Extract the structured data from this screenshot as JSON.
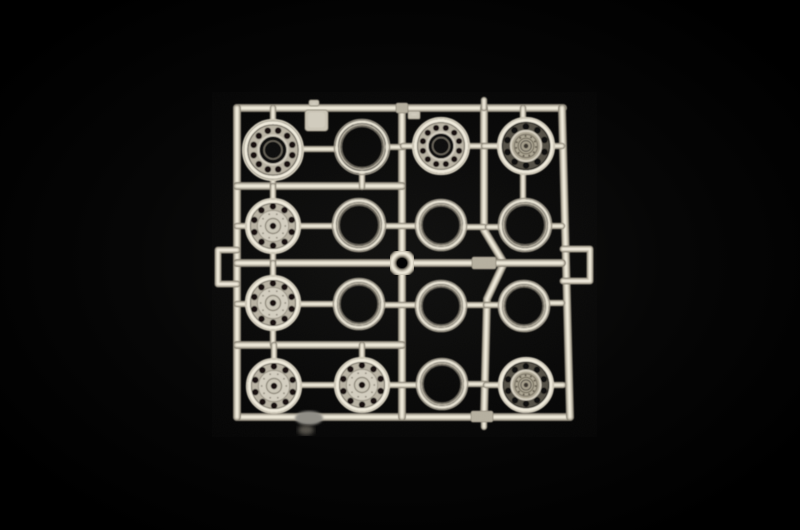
{
  "scene": {
    "subject": "Plastic model kit sprue with sixteen truck wheel parts photographed on a black background",
    "background": "#000000",
    "vignette_center": "#121211",
    "plastic": {
      "shadow": "#8d8779",
      "mid": "#cdc7b7",
      "highlight": "#eee9da",
      "face_light": "#d3cec0",
      "face_mid": "#b9b3a4",
      "hole": "#13110e",
      "hubcap": "#aea794",
      "annulus_dark": "#555147",
      "block": "#b5af9f"
    }
  },
  "sprue": {
    "frame": {
      "rail_width": 8,
      "stub_width": 6.5,
      "rails": [
        {
          "name": "top-rail",
          "points": [
            [
              237,
              108
            ],
            [
              563,
              108
            ]
          ]
        },
        {
          "name": "bottom-rail",
          "points": [
            [
              237,
              417
            ],
            [
              570,
              417
            ]
          ]
        },
        {
          "name": "left-rail",
          "points": [
            [
              237,
              108
            ],
            [
              237,
              417
            ]
          ]
        },
        {
          "name": "right-rail",
          "points": [
            [
              562,
              108
            ],
            [
              570,
              417
            ]
          ]
        },
        {
          "name": "center-vertical-rail",
          "points": [
            [
              402,
              108
            ],
            [
              402,
              417
            ]
          ]
        },
        {
          "name": "inner-right-rail",
          "points": [
            [
              484,
              108
            ],
            [
              484,
              230
            ],
            [
              504,
              263
            ],
            [
              487,
              299
            ],
            [
              484,
              417
            ]
          ]
        },
        {
          "name": "upper-horizontal-rail",
          "points": [
            [
              237,
              186
            ],
            [
              402,
              186
            ]
          ]
        },
        {
          "name": "middle-horizontal-rail",
          "points": [
            [
              237,
              263
            ],
            [
              562,
              263
            ]
          ]
        },
        {
          "name": "lower-horizontal-rail",
          "points": [
            [
              237,
              345
            ],
            [
              402,
              345
            ]
          ]
        }
      ],
      "handles": [
        {
          "name": "left-handle-loop",
          "points": [
            [
              237,
              250
            ],
            [
              218,
              250
            ],
            [
              218,
              284
            ],
            [
              237,
              284
            ]
          ]
        },
        {
          "name": "right-handle-loop",
          "points": [
            [
              563,
              249
            ],
            [
              590,
              249
            ],
            [
              590,
              281
            ],
            [
              563,
              281
            ]
          ]
        }
      ],
      "blocks": [
        {
          "name": "square-gate-tab",
          "x": 305,
          "y": 110,
          "w": 23,
          "h": 21,
          "rx": 3
        },
        {
          "name": "small-gate-tab",
          "x": 408,
          "y": 111,
          "w": 12,
          "h": 8,
          "rx": 1.5
        },
        {
          "name": "nub-tab",
          "x": 309,
          "y": 100,
          "w": 10,
          "h": 6,
          "rx": 2
        }
      ],
      "gate_blocks": [
        [
          396,
          103,
          12,
          10
        ],
        [
          472,
          257,
          24,
          12
        ],
        [
          471,
          411,
          22,
          11
        ]
      ],
      "center_ring": {
        "cx": 402,
        "cy": 263,
        "r": 10,
        "w": 8,
        "hole_r": 6.2
      },
      "stubs": [
        [
          273,
          108,
          273,
          121
        ],
        [
          273,
          179,
          273,
          187
        ],
        [
          302,
          149,
          335,
          149
        ],
        [
          388,
          147,
          403,
          147
        ],
        [
          403,
          146,
          413,
          146
        ],
        [
          468,
          146,
          484,
          146
        ],
        [
          484,
          146,
          498,
          146
        ],
        [
          523,
          108,
          523,
          119
        ],
        [
          553,
          146,
          562,
          146
        ],
        [
          362,
          174,
          362,
          187
        ],
        [
          523,
          174,
          523,
          199
        ],
        [
          237,
          226,
          246,
          226
        ],
        [
          273,
          186,
          273,
          199
        ],
        [
          273,
          253,
          273,
          263
        ],
        [
          301,
          226,
          333,
          226
        ],
        [
          385,
          226,
          416,
          226
        ],
        [
          465,
          227,
          484,
          227
        ],
        [
          488,
          227,
          499,
          227
        ],
        [
          551,
          226,
          562,
          226
        ],
        [
          237,
          304,
          247,
          304
        ],
        [
          273,
          263,
          273,
          277
        ],
        [
          273,
          330,
          273,
          345
        ],
        [
          301,
          304,
          334,
          304
        ],
        [
          384,
          305,
          416,
          305
        ],
        [
          466,
          305,
          488,
          305
        ],
        [
          486,
          305,
          499,
          305
        ],
        [
          549,
          303,
          562,
          303
        ],
        [
          274,
          345,
          274,
          359
        ],
        [
          362,
          345,
          362,
          358
        ],
        [
          302,
          385,
          334,
          385
        ],
        [
          389,
          385,
          417,
          385
        ],
        [
          466,
          384,
          486,
          384
        ],
        [
          486,
          385,
          499,
          385
        ],
        [
          553,
          385,
          563,
          385
        ],
        [
          484,
          100,
          484,
          108
        ],
        [
          484,
          417,
          484,
          427
        ]
      ]
    },
    "part_types": {
      "hub-open": "wheel rim with open hub bore and ring of bolt holes",
      "hub-face": "wheel hub with flat face, bolt holes and small center hole",
      "ring": "plain tire ring hoop",
      "wheel-cap": "complete wheel with detailed textured hub cap"
    },
    "parts": [
      {
        "row": 1,
        "col": 1,
        "type": "hub-open",
        "cx": 273,
        "cy": 150,
        "r": 31
      },
      {
        "row": 1,
        "col": 2,
        "type": "ring",
        "cx": 362,
        "cy": 147,
        "r": 28
      },
      {
        "row": 1,
        "col": 3,
        "type": "hub-open",
        "cx": 441,
        "cy": 146,
        "r": 29
      },
      {
        "row": 1,
        "col": 4,
        "type": "wheel-cap",
        "cx": 526,
        "cy": 146,
        "r": 29
      },
      {
        "row": 2,
        "col": 1,
        "type": "hub-face",
        "cx": 273,
        "cy": 226,
        "r": 28
      },
      {
        "row": 2,
        "col": 2,
        "type": "ring",
        "cx": 359,
        "cy": 225,
        "r": 27
      },
      {
        "row": 2,
        "col": 3,
        "type": "ring",
        "cx": 441,
        "cy": 225,
        "r": 26
      },
      {
        "row": 2,
        "col": 4,
        "type": "ring",
        "cx": 525,
        "cy": 225,
        "r": 27
      },
      {
        "row": 3,
        "col": 1,
        "type": "hub-face",
        "cx": 273,
        "cy": 303,
        "r": 28
      },
      {
        "row": 3,
        "col": 2,
        "type": "ring",
        "cx": 359,
        "cy": 304,
        "r": 26
      },
      {
        "row": 3,
        "col": 3,
        "type": "ring",
        "cx": 441,
        "cy": 306,
        "r": 26
      },
      {
        "row": 3,
        "col": 4,
        "type": "ring",
        "cx": 524,
        "cy": 306,
        "r": 26
      },
      {
        "row": 4,
        "col": 1,
        "type": "hub-face",
        "cx": 274,
        "cy": 386,
        "r": 28
      },
      {
        "row": 4,
        "col": 2,
        "type": "hub-face",
        "cx": 362,
        "cy": 385,
        "r": 28
      },
      {
        "row": 4,
        "col": 3,
        "type": "ring",
        "cx": 442,
        "cy": 384,
        "r": 26
      },
      {
        "row": 4,
        "col": 4,
        "type": "wheel-cap",
        "cx": 526,
        "cy": 385,
        "r": 28
      }
    ],
    "unfocused_blobs": [
      {
        "cx": 309,
        "cy": 418,
        "rx": 14,
        "ry": 7,
        "color": "#8f8d86",
        "blur": "blur2"
      },
      {
        "cx": 306,
        "cy": 430,
        "rx": 8,
        "ry": 5,
        "color": "#56534c",
        "blur": "blur3"
      }
    ]
  }
}
